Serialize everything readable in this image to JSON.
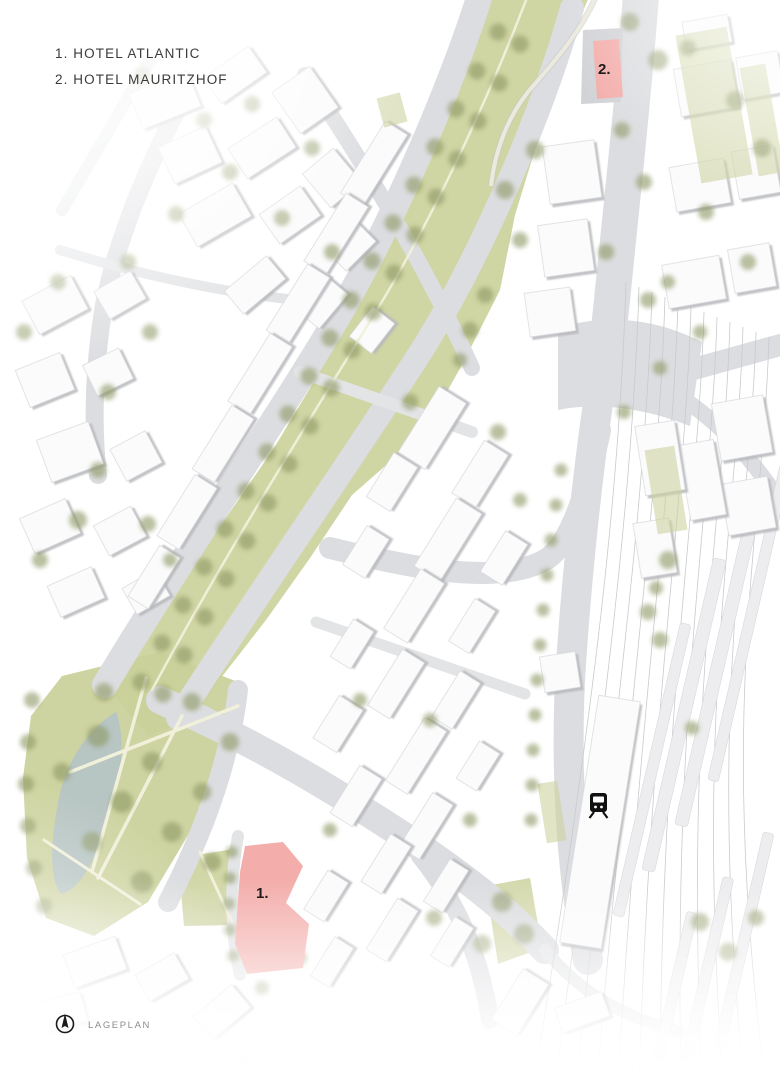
{
  "page": {
    "type": "architectural-site-plan"
  },
  "legend": {
    "items": [
      {
        "text": "1. HOTEL ATLANTIC"
      },
      {
        "text": "2. HOTEL MAURITZHOF"
      }
    ]
  },
  "markers": {
    "hotel_atlantic": "1.",
    "hotel_mauritzhof": "2."
  },
  "footer": {
    "label": "LAGEPLAN"
  },
  "icons": {
    "north_arrow": "north-arrow-icon",
    "train_station": "train-icon"
  },
  "colors": {
    "background": "#ffffff",
    "road": "#dcdde0",
    "road_minor": "#e3e4e6",
    "building": "#fbfbfc",
    "building_outline": "#d6d7da",
    "building_shadow": "#b7b8bc",
    "green": "#cad099",
    "courtyard_green": "#cdd39f",
    "tree": "#8f9a66",
    "water": "#b5c4c5",
    "path": "#f1f0da",
    "rail": "#c9cacd",
    "platform": "#ededef",
    "highlight": "#f3aeab",
    "marker_text": "#1c1c1c",
    "legend_text": "#3b3b3b",
    "footer_text": "#8d8d90"
  }
}
